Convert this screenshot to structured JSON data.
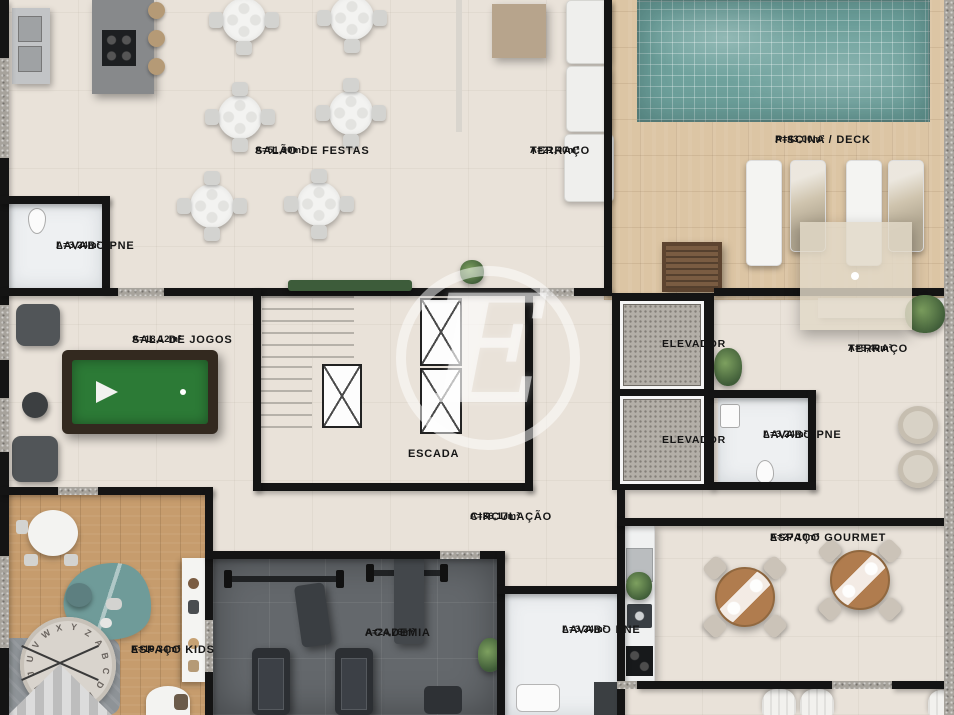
{
  "watermark_letter": "E",
  "kids_rug_letters": "UVWXYZABCDEFGHIJ",
  "rooms": {
    "salao": {
      "label": "SALÃO DE FESTAS",
      "area": "A=51,90m²"
    },
    "terraco1": {
      "label": "TERRAÇO",
      "area": "A=21,40m²"
    },
    "piscina": {
      "label": "PISCINA / DECK",
      "area": "A=43,00m²"
    },
    "lavabo1": {
      "label": "LAVABO PNE",
      "area": "A=3,24m²"
    },
    "jogos": {
      "label": "SALA DE JOGOS",
      "area": "A=18,12m²"
    },
    "escada": {
      "label": "ESCADA"
    },
    "elevador1": {
      "label": "ELEVADOR"
    },
    "elevador2": {
      "label": "ELEVADOR"
    },
    "terraco2": {
      "label": "TERRAÇO",
      "area": "A=9,40m²"
    },
    "lavabo2": {
      "label": "LAVABO PNE",
      "area": "A=3,24m²"
    },
    "circulacao": {
      "label": "CIRCULAÇÃO",
      "area": "A=36,17m²"
    },
    "kids": {
      "label": "ESPAÇO KIDS",
      "area": "A=19,34m²"
    },
    "academia": {
      "label": "ACADEMIA",
      "area": "A=24,76m²"
    },
    "lavabo3": {
      "label": "LAVABO PNE",
      "area": "A=3,24m²"
    },
    "gourmet": {
      "label": "ESPAÇO GOURMET",
      "area": "A=27,10m²"
    }
  },
  "colors": {
    "wall": "#141414",
    "floor": "#e9e2d9",
    "pool_water": "#6fa29d",
    "deck_wood": "#dcc5a4",
    "kids_wood": "#c69c6d",
    "gym_floor": "#64686c",
    "pool_table_felt": "#2c7a36",
    "label_text": "#151515"
  }
}
